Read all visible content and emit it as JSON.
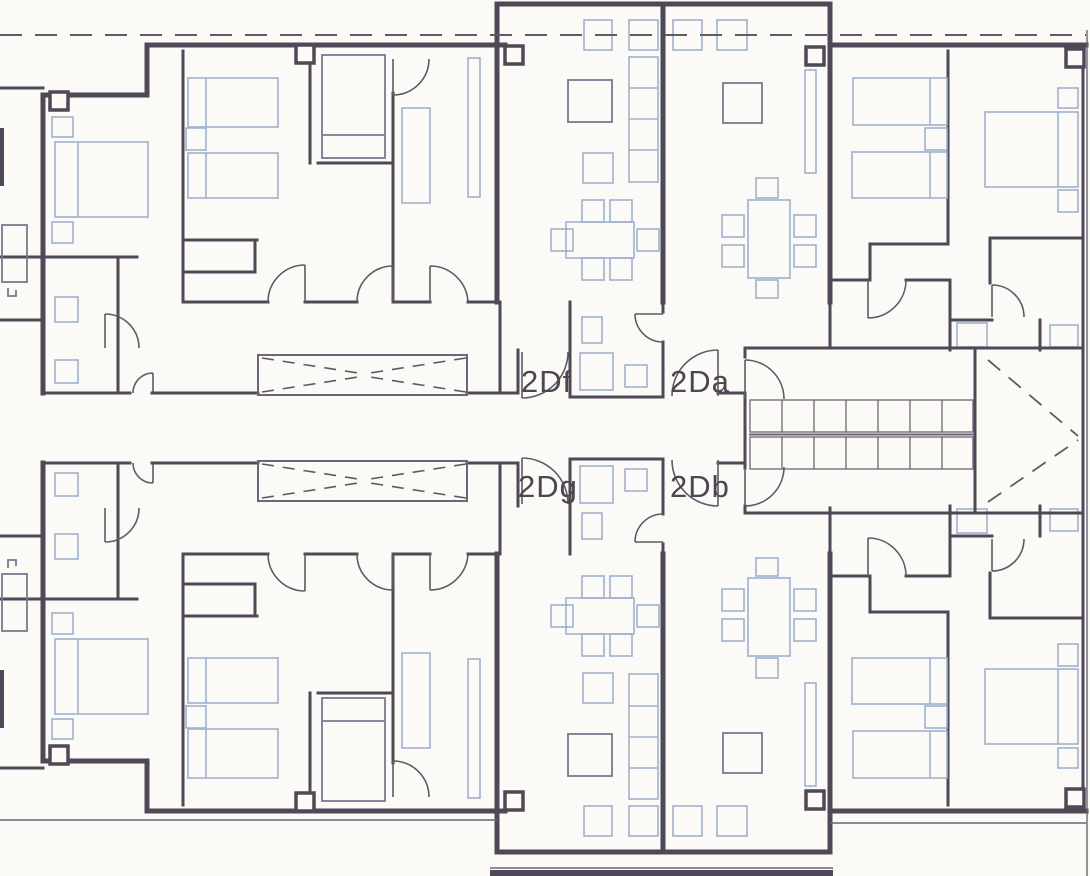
{
  "drawing": {
    "type": "architectural-floor-plan",
    "units": [
      {
        "id": "unit-top-left-center",
        "label": "2Df"
      },
      {
        "id": "unit-top-right-center",
        "label": "2Da"
      },
      {
        "id": "unit-bottom-left-center",
        "label": "2Dg"
      },
      {
        "id": "unit-bottom-right-center",
        "label": "2Db"
      }
    ]
  },
  "colors": {
    "paper": "#fbfaf6",
    "wall": "#4e4857",
    "wall2": "#6b6575",
    "furn": "#9fb1cf",
    "furnd": "#7d7790",
    "ink": "#4b4650",
    "dash": "#5f5a68"
  }
}
